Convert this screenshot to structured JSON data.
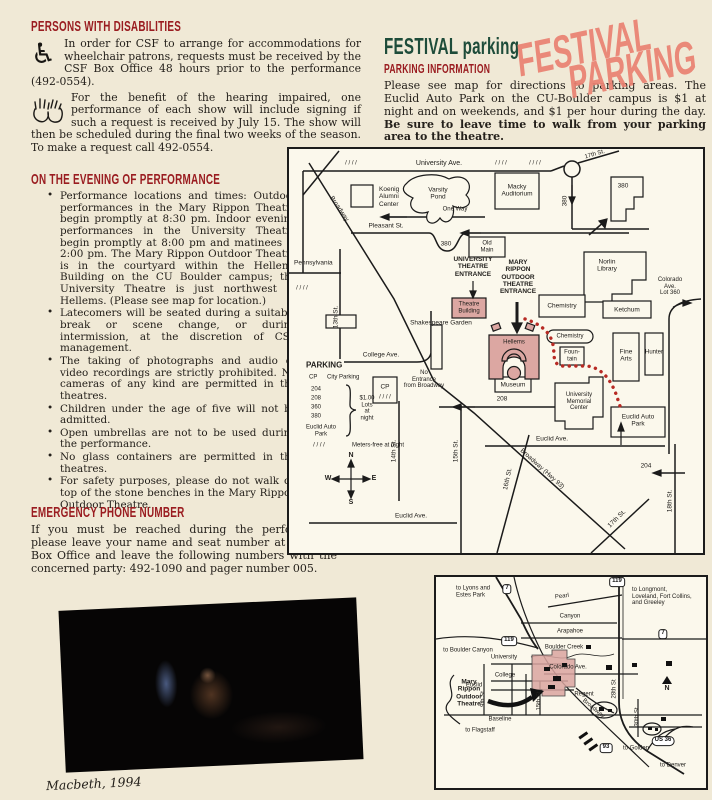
{
  "theme": {
    "page_bg": "#f0e9d6",
    "ink": "#24201b",
    "heading_red": "#9a1c20",
    "heading_green": "#1e4c3a",
    "stamp_salmon": "#ea8172",
    "map_pink": "#dca7a2",
    "path_red": "#b72a24",
    "map_bg": "#fbf8ec"
  },
  "left": {
    "disabilities": {
      "heading": "PERSONS WITH DISABILITIES",
      "wheelchair_glyph": "♿",
      "para1": "In order for CSF to arrange for accommodations for wheelchair patrons, requests must be received by the CSF Box Office 48 hours prior to the performance (492-0554).",
      "para2": "For the benefit of the hearing impaired, one performance of each show will include signing if such a request is received by July 15.  The show will then be scheduled during the final two weeks of the season.  To make a request call 492-0554."
    },
    "evening": {
      "heading": "ON THE EVENING OF PERFORMANCE",
      "items": [
        "Performance locations and times:  Outdoor performances in the Mary Rippon Theatre begin promptly at 8:30 pm.  Indoor evening performances in the University Theatre begin promptly at 8:00 pm and matinees at 2:00 pm. The Mary Rippon Outdoor Theatre is in the courtyard within the Hellems Building on the CU Boulder campus; the University Theatre is just northwest of Hellems.  (Please see map for location.)",
        "Latecomers will be seated during a suitable break or scene change, or during intermission, at the discretion of CSF management.",
        "The taking of photographs and audio or video recordings are strictly prohibited.  No cameras of any kind are permitted in the theatres.",
        "Children under the age of five will not be admitted.",
        "Open umbrellas are not to be used during the performance.",
        "No glass containers are permitted in the theatres.",
        "For safety purposes, please do not walk on top of the stone benches in the Mary Rippon Outdoor Theatre."
      ]
    },
    "emergency": {
      "heading": "EMERGENCY PHONE NUMBER",
      "para": "If you must be reached during the performance, please leave your name and seat number at the CSF Box Office and leave the following numbers with the concerned party: 492-1090 and pager number 005."
    },
    "photo_caption": "Macbeth, 1994"
  },
  "right": {
    "title": "FESTIVAL parking",
    "info_heading": "PARKING INFORMATION",
    "para_normal": "Please see map for directions to parking areas.  The Euclid Auto Park on the CU-Boulder campus is $1 at night and on weekends, and $1 per hour during the day.  ",
    "para_bold": "Be sure to leave time to walk from your parking area to the theatre.",
    "stamp_line1": "FESTIVAL",
    "stamp_line2": "PARKING"
  },
  "map1": {
    "labels": {
      "hatch": "/ / / /",
      "university_ave": "University Ave.",
      "broadway": "Broadway",
      "koenig": "Koenig\nAlumni\nCenter",
      "varsity_pond": "Varsity\nPond",
      "one_way": "One Way",
      "pleasant": "Pleasant St.",
      "r380_street": "380",
      "r380_dip": "380",
      "b380": "380",
      "macky": "Macky\nAuditorium",
      "old_main": "Old\nMain",
      "pennsylvania": "Pennsylvania",
      "st17_top": "17th St.",
      "norlin": "Norlin\nLibrary",
      "colorado_lot": "Colorado Ave.\nLot 360",
      "univ_entrance": "UNIVERSITY\nTHEATRE\nENTRANCE",
      "mary_entrance": "MARY\nRIPPON\nOUTDOOR\nTHEATRE\nENTRANCE",
      "theatre_bldg": "Theatre\nBuilding",
      "shakespeare": "Shakespeare Garden",
      "hellems": "Hellems",
      "chemistry1": "Chemistry",
      "chemistry2": "Chemistry",
      "ketchum": "Ketchum",
      "fountain": "Foun-\ntain",
      "fine_arts": "Fine\nArts",
      "hunter": "Hunter",
      "museum": "Museum",
      "umc": "University\nMemorial\nCenter",
      "euclid_auto": "Euclid Auto\nPark",
      "st13": "13th St.",
      "st14": "14th St.",
      "st15": "15th St.",
      "st16": "16th St.",
      "st17": "17th St.",
      "st18": "18th St.",
      "broadway_hwy": "Broadway (Hwy 93)",
      "college_ave": "College Ave.",
      "cp_box": "CP",
      "no_entrance": "No\nEntrance\nfrom Broadway",
      "r208": "208",
      "euclid_ave_r": "Euclid Ave.",
      "euclid_ave_l": "Euclid Ave.",
      "lot204": "204"
    },
    "legend": {
      "title": "PARKING",
      "cp": "CP",
      "city": "City Parking",
      "l204": "204",
      "l208": "208",
      "l360": "360",
      "l380": "380",
      "euclid": "Euclid Auto\nPark",
      "price": "$1.00\nLots\nat\nnight",
      "meters": "Meters-free at night"
    },
    "compass": {
      "n": "N",
      "s": "S",
      "e": "E",
      "w": "W"
    }
  },
  "map2": {
    "labels": {
      "lyons": "to Lyons and\nEstes Park",
      "longmont": "to Longmont,\nLoveland, Fort Collins,\nand Greeley",
      "boulder_canyon": "to Boulder Canyon",
      "flagstaff": "to Flagstaff",
      "golden": "to Golden",
      "denver": "to Denver",
      "pearl": "Pearl",
      "canyon": "Canyon",
      "arapahoe": "Arapahoe",
      "boulder_creek": "Boulder Creek",
      "university": "University",
      "colorado": "Colorado Ave.",
      "college": "College",
      "euclid": "Euclid",
      "baseline": "Baseline",
      "regent": "Regent",
      "mary_rippon": "Mary\nRippon\nOutdoor\nTheatre",
      "n": "N",
      "s9th": "9th St",
      "s15th": "15th St",
      "broadway": "Broadway",
      "s28th": "28th St",
      "s30th": "30th St"
    },
    "shields": {
      "s7a": "7",
      "s7b": "7",
      "s119a": "119",
      "s119b": "119",
      "s93": "93",
      "us36": "US 36"
    }
  }
}
